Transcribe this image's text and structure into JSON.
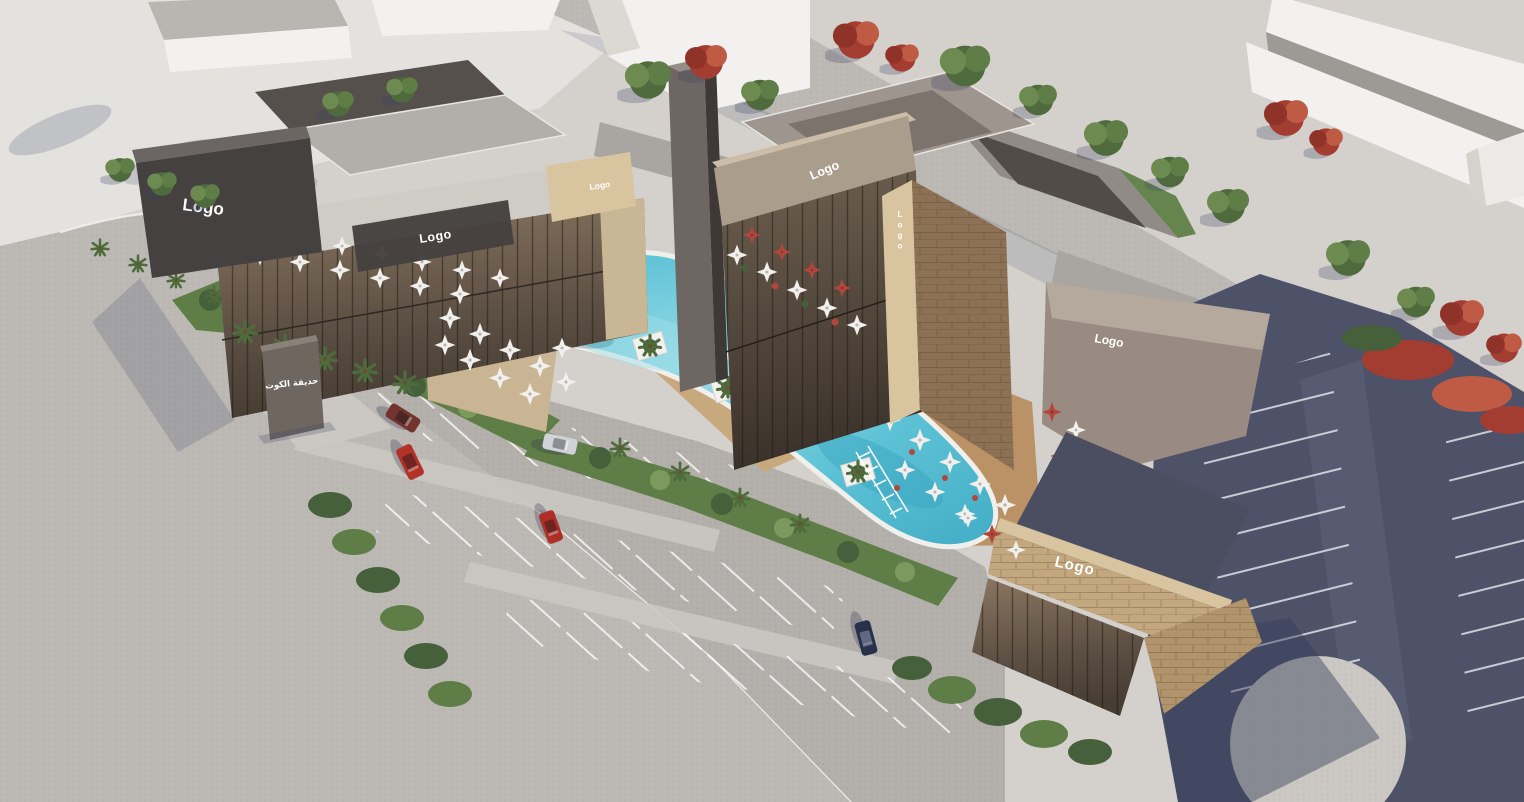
{
  "scene": {
    "type": "3d-architectural-aerial-rendering",
    "subject": "commercial plaza with lagoon pool, restaurant buildings, landscaping and parking"
  },
  "signs": {
    "left_wedge": "Logo",
    "left_band": "Logo",
    "left_corner": "Logo",
    "center_parapet": "Logo",
    "center_vertical": "Logo",
    "right_tower": "Logo",
    "right_stone": "Logo",
    "monument_arabic": "حديقة الكوت"
  },
  "vehicles": [
    {
      "name": "maroon-sedan",
      "color": "#74342e"
    },
    {
      "name": "red-suv",
      "color": "#b23227"
    },
    {
      "name": "silver-sedan",
      "color": "#cfd2d6"
    },
    {
      "name": "red-hatchback",
      "color": "#ad2f26"
    },
    {
      "name": "navy-sedan",
      "color": "#27324a"
    }
  ],
  "colors": {
    "ground": "#d4d1cd",
    "plazaLight": "#e4e2df",
    "road": "#bcb9b5",
    "walk": "#cbc8c3",
    "parkLight": "#b3b0ac",
    "parkDark": "#4d5269",
    "pool": "#5ec2d6",
    "poolLight": "#9fdde8",
    "poolDeep": "#3aa6c0",
    "green": "#5f7d46",
    "greenDark": "#45603a",
    "greenLight": "#7d9a5e",
    "redTree": "#a33d31",
    "redTreeLight": "#bf5a44",
    "stone": "#c3a87f",
    "stoneLight": "#d8c49f",
    "stoneDark": "#a78a62",
    "darkStone": "#8d7155",
    "taupe": "#998b81",
    "taupeLight": "#b5a99e",
    "signDark": "#454140",
    "roofDark": "#55504c",
    "glass": "#7a6a58",
    "glassDark": "#463d33",
    "whiteBld": "#f2f1ef",
    "umbrella": "#f2f0ec",
    "umbrellaRed": "#b2463a",
    "deckWood": "#bb9166"
  }
}
